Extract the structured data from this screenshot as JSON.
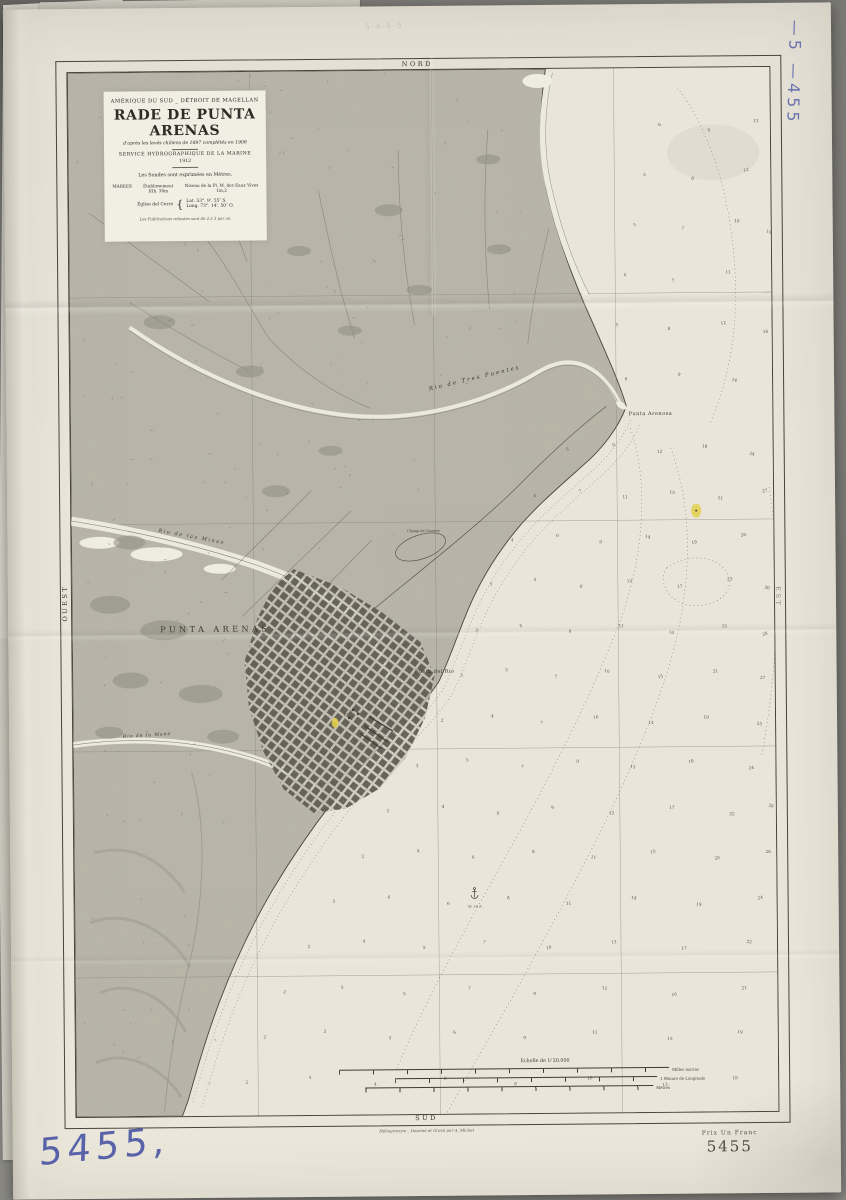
{
  "photo": {
    "background_color": "#82817c",
    "paper_color": "#e7e3d8",
    "blue_ink_color": "#4d58a6",
    "accent_yellow": "#e3cf4b",
    "handwritten_number": "5455,",
    "handwritten_number_vertical": "—5 —455",
    "pencil_note": "5·4·5·5"
  },
  "chart": {
    "directions": {
      "north": "NORD",
      "south": "SUD",
      "west": "OUEST",
      "east": "EST"
    },
    "title_block": {
      "region": "AMÉRIQUE DU SUD _ DÉTROIT DE MAGELLAN",
      "title": "RADE DE PUNTA ARENAS",
      "subtitle": "d'après les levés chiliens de 1897 complétés en 1908",
      "agency": "SERVICE HYDROGRAPHIQUE DE LA MARINE",
      "year": "1912",
      "soundings_note": "Les Sondes sont exprimées en Mètres.",
      "tides_label": "MARÉES",
      "establishment_label": "Établissement",
      "establishment_value": "IIIh. 30m",
      "level_label": "Niveau de la Pl. M. des Eaux Vives",
      "level_value": "1m,2",
      "station_label": "Église del Cerro",
      "lat_label": "Lat.",
      "lat_value": "53°. 9'. 55″ S.",
      "long_label": "Long.",
      "long_value": "73°. 14'. 50″ O.",
      "footnote": "Les Publications relevées sont de 2 à 3 par an."
    },
    "scale_block": {
      "title": "Echelle de 1⁄ 20.000",
      "bars": [
        {
          "label": "Milles marins"
        },
        {
          "label": "1 Minute de Longitude"
        },
        {
          "label": "Mètres"
        }
      ]
    },
    "imprint": "Héliogravure _ Dessiné et Gravé par A. Michel",
    "price": "Prix Un Franc",
    "catalog_number": "5455",
    "labels": [
      {
        "t": "PUNTA ARENAS",
        "x": 143,
        "y": 560,
        "s": 8,
        "ls": 3.5,
        "r": 0,
        "i": false
      },
      {
        "t": "Punta Arenosa",
        "x": 580,
        "y": 347,
        "s": 5,
        "ls": 0.5,
        "r": 0,
        "i": false
      },
      {
        "t": "Punta del Rio",
        "x": 362,
        "y": 603,
        "s": 5,
        "ls": 0.4,
        "r": 0,
        "i": false
      },
      {
        "t": "Rio  de  Tres  Puentes",
        "x": 405,
        "y": 310,
        "s": 5.5,
        "ls": 2,
        "r": -13,
        "i": true
      },
      {
        "t": "Rio  de  las  Minas",
        "x": 120,
        "y": 466,
        "s": 5,
        "ls": 1.6,
        "r": 11,
        "i": true
      },
      {
        "t": "Rio de la Mano",
        "x": 74,
        "y": 664,
        "s": 4.5,
        "ls": 1,
        "r": -3,
        "i": true
      },
      {
        "t": "Champ de Courses",
        "x": 352,
        "y": 462,
        "s": 3.4,
        "ls": 0,
        "r": 0,
        "i": false
      },
      {
        "t": "Muelle",
        "x": 276,
        "y": 643,
        "s": 3,
        "ls": 0,
        "r": -32,
        "i": true
      },
      {
        "t": "W. 30 E.",
        "x": 401,
        "y": 838,
        "s": 3,
        "ls": 0.3,
        "r": 0,
        "i": true
      }
    ],
    "soundings": [
      [
        592,
        58,
        6
      ],
      [
        641,
        64,
        9
      ],
      [
        688,
        55,
        13
      ],
      [
        576,
        108,
        5
      ],
      [
        624,
        112,
        8
      ],
      [
        678,
        104,
        12
      ],
      [
        566,
        158,
        5
      ],
      [
        614,
        162,
        7
      ],
      [
        668,
        155,
        10
      ],
      [
        700,
        166,
        14
      ],
      [
        556,
        208,
        4
      ],
      [
        604,
        214,
        7
      ],
      [
        659,
        206,
        11
      ],
      [
        547,
        258,
        5
      ],
      [
        599,
        262,
        8
      ],
      [
        654,
        257,
        12
      ],
      [
        696,
        266,
        16
      ],
      [
        556,
        312,
        6
      ],
      [
        609,
        308,
        9
      ],
      [
        664,
        314,
        14
      ],
      [
        497,
        382,
        5
      ],
      [
        543,
        378,
        9
      ],
      [
        589,
        385,
        12
      ],
      [
        634,
        380,
        18
      ],
      [
        681,
        388,
        24
      ],
      [
        464,
        428,
        4
      ],
      [
        509,
        424,
        7
      ],
      [
        554,
        430,
        11
      ],
      [
        601,
        426,
        15
      ],
      [
        649,
        432,
        21
      ],
      [
        694,
        425,
        27
      ],
      [
        441,
        472,
        4
      ],
      [
        486,
        468,
        6
      ],
      [
        529,
        475,
        9
      ],
      [
        576,
        470,
        14
      ],
      [
        623,
        476,
        19
      ],
      [
        672,
        469,
        26
      ],
      [
        419,
        516,
        3
      ],
      [
        463,
        512,
        5
      ],
      [
        509,
        519,
        8
      ],
      [
        558,
        514,
        12
      ],
      [
        608,
        520,
        17
      ],
      [
        658,
        513,
        23
      ],
      [
        695,
        522,
        30
      ],
      [
        404,
        562,
        3
      ],
      [
        449,
        558,
        5
      ],
      [
        498,
        564,
        8
      ],
      [
        549,
        559,
        11
      ],
      [
        599,
        566,
        16
      ],
      [
        652,
        560,
        22
      ],
      [
        693,
        568,
        28
      ],
      [
        389,
        607,
        3
      ],
      [
        434,
        602,
        5
      ],
      [
        483,
        609,
        7
      ],
      [
        534,
        604,
        10
      ],
      [
        588,
        610,
        15
      ],
      [
        643,
        605,
        21
      ],
      [
        690,
        612,
        27
      ],
      [
        369,
        652,
        2
      ],
      [
        419,
        648,
        4
      ],
      [
        469,
        655,
        7
      ],
      [
        523,
        650,
        10
      ],
      [
        578,
        656,
        14
      ],
      [
        633,
        651,
        19
      ],
      [
        686,
        658,
        25
      ],
      [
        344,
        697,
        3
      ],
      [
        394,
        692,
        5
      ],
      [
        449,
        699,
        7
      ],
      [
        504,
        694,
        9
      ],
      [
        559,
        700,
        13
      ],
      [
        618,
        695,
        18
      ],
      [
        678,
        702,
        24
      ],
      [
        314,
        742,
        3
      ],
      [
        369,
        738,
        4
      ],
      [
        424,
        745,
        6
      ],
      [
        479,
        740,
        9
      ],
      [
        538,
        746,
        12
      ],
      [
        598,
        741,
        17
      ],
      [
        658,
        748,
        22
      ],
      [
        697,
        740,
        28
      ],
      [
        289,
        787,
        2
      ],
      [
        344,
        782,
        4
      ],
      [
        399,
        789,
        6
      ],
      [
        459,
        784,
        8
      ],
      [
        519,
        790,
        11
      ],
      [
        579,
        785,
        15
      ],
      [
        643,
        792,
        20
      ],
      [
        694,
        786,
        26
      ],
      [
        259,
        832,
        3
      ],
      [
        314,
        828,
        4
      ],
      [
        374,
        835,
        6
      ],
      [
        434,
        830,
        8
      ],
      [
        494,
        836,
        11
      ],
      [
        559,
        831,
        14
      ],
      [
        624,
        838,
        19
      ],
      [
        686,
        832,
        24
      ],
      [
        234,
        877,
        2
      ],
      [
        289,
        872,
        4
      ],
      [
        349,
        879,
        5
      ],
      [
        409,
        874,
        7
      ],
      [
        474,
        880,
        10
      ],
      [
        539,
        875,
        13
      ],
      [
        609,
        882,
        17
      ],
      [
        674,
        876,
        22
      ],
      [
        209,
        922,
        2
      ],
      [
        267,
        918,
        3
      ],
      [
        329,
        925,
        5
      ],
      [
        394,
        920,
        7
      ],
      [
        459,
        926,
        9
      ],
      [
        529,
        921,
        12
      ],
      [
        599,
        928,
        16
      ],
      [
        669,
        922,
        21
      ],
      [
        189,
        967,
        2
      ],
      [
        249,
        962,
        3
      ],
      [
        314,
        969,
        5
      ],
      [
        379,
        964,
        6
      ],
      [
        449,
        970,
        9
      ],
      [
        519,
        965,
        11
      ],
      [
        594,
        972,
        15
      ],
      [
        664,
        966,
        19
      ],
      [
        171,
        1012,
        2
      ],
      [
        234,
        1008,
        3
      ],
      [
        299,
        1015,
        4
      ],
      [
        369,
        1010,
        6
      ],
      [
        439,
        1016,
        8
      ],
      [
        514,
        1011,
        10
      ],
      [
        589,
        1018,
        13
      ],
      [
        659,
        1012,
        18
      ]
    ],
    "speckle_regions": [
      {
        "x": 0,
        "y": 0,
        "w": 455,
        "h": 315,
        "n": 62
      },
      {
        "x": 0,
        "y": 315,
        "w": 350,
        "h": 185,
        "n": 40
      },
      {
        "x": 0,
        "y": 500,
        "w": 255,
        "h": 200,
        "n": 28
      },
      {
        "x": 0,
        "y": 700,
        "w": 150,
        "h": 320,
        "n": 24
      }
    ]
  }
}
